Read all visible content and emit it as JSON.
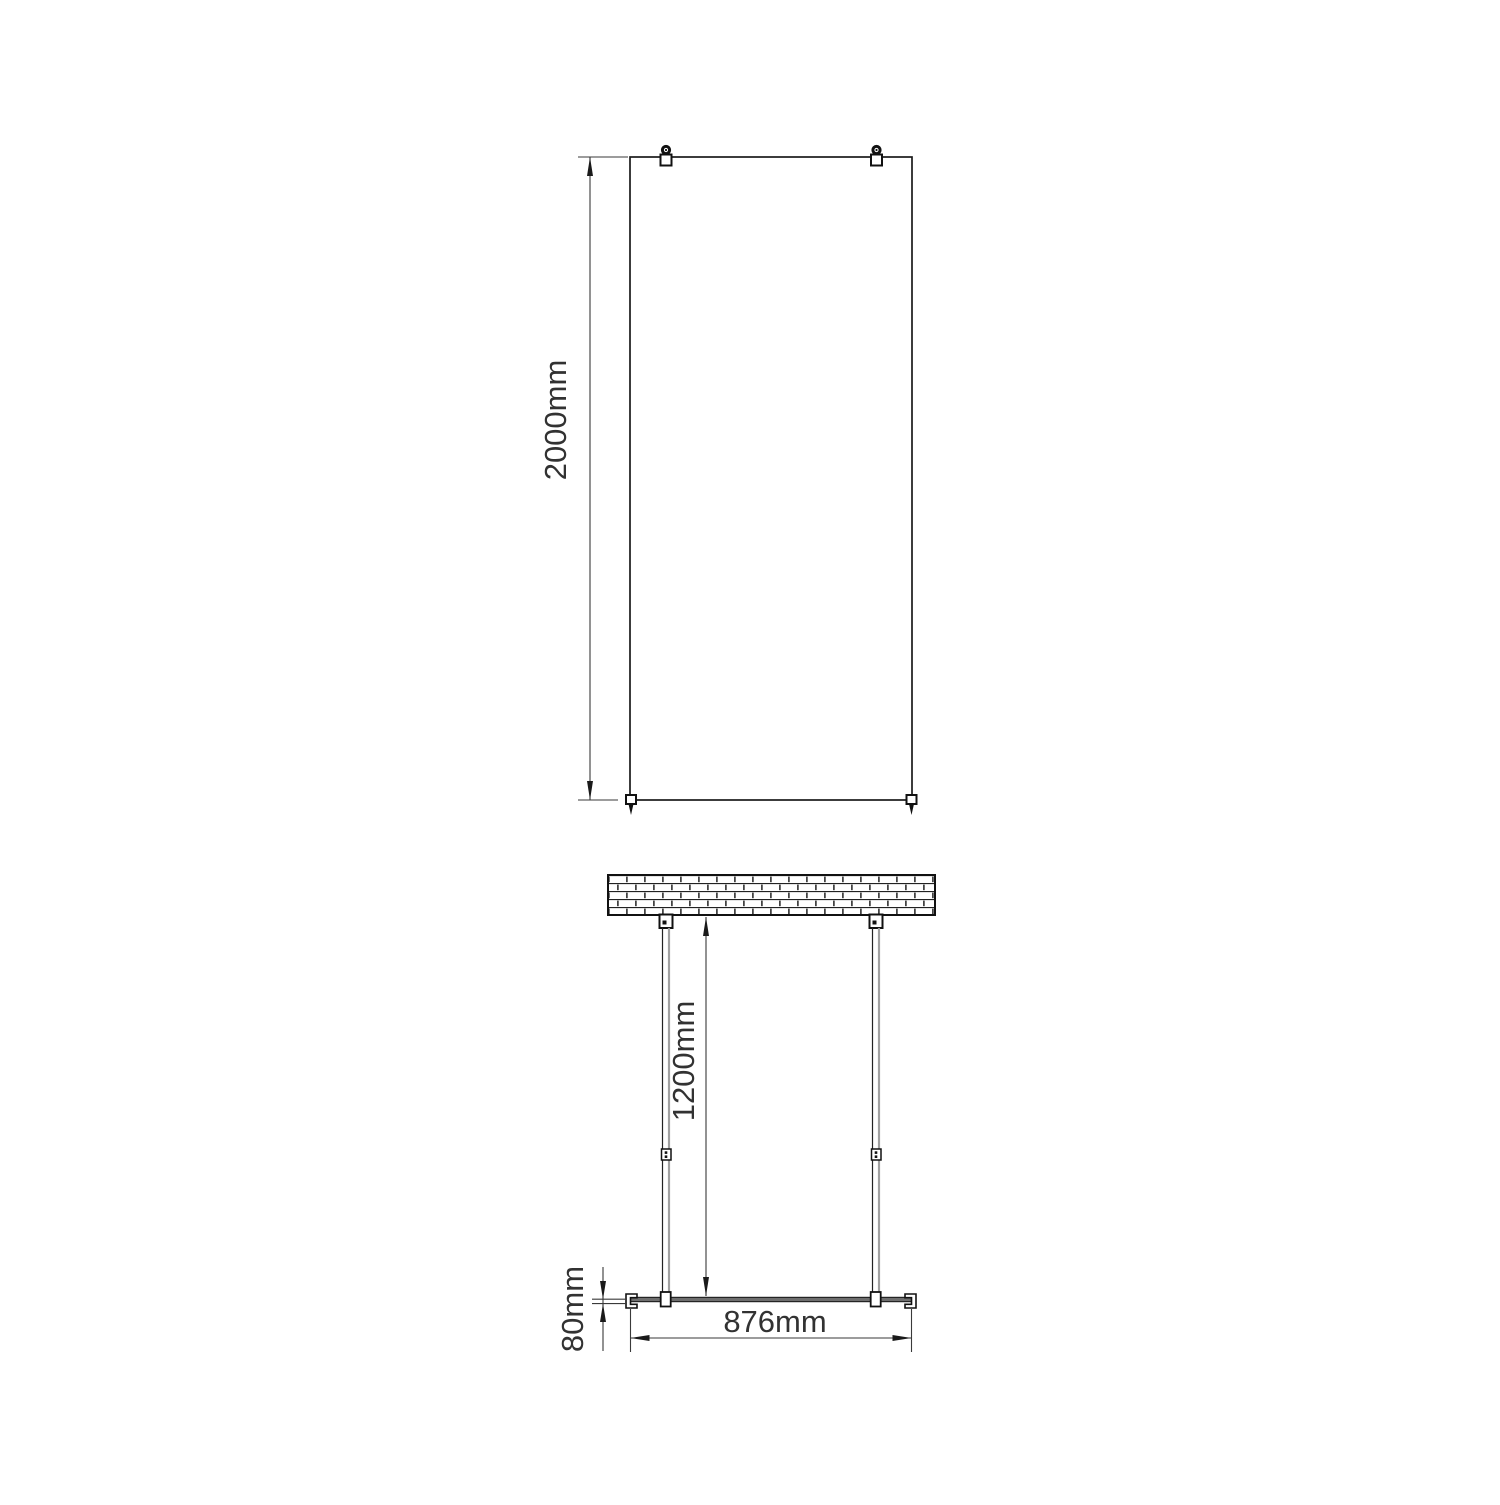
{
  "drawing": {
    "front_view": {
      "height_label": "2000mm"
    },
    "plan_view": {
      "depth_label": "1200mm",
      "offset_label": "80mm",
      "width_label": "876mm"
    },
    "colors": {
      "line": "#1a1a1a",
      "dim_line": "#3a3a3a",
      "tube_highlight": "#a0a0a0",
      "glass_fill": "#6e6e6e",
      "background": "#ffffff"
    }
  }
}
